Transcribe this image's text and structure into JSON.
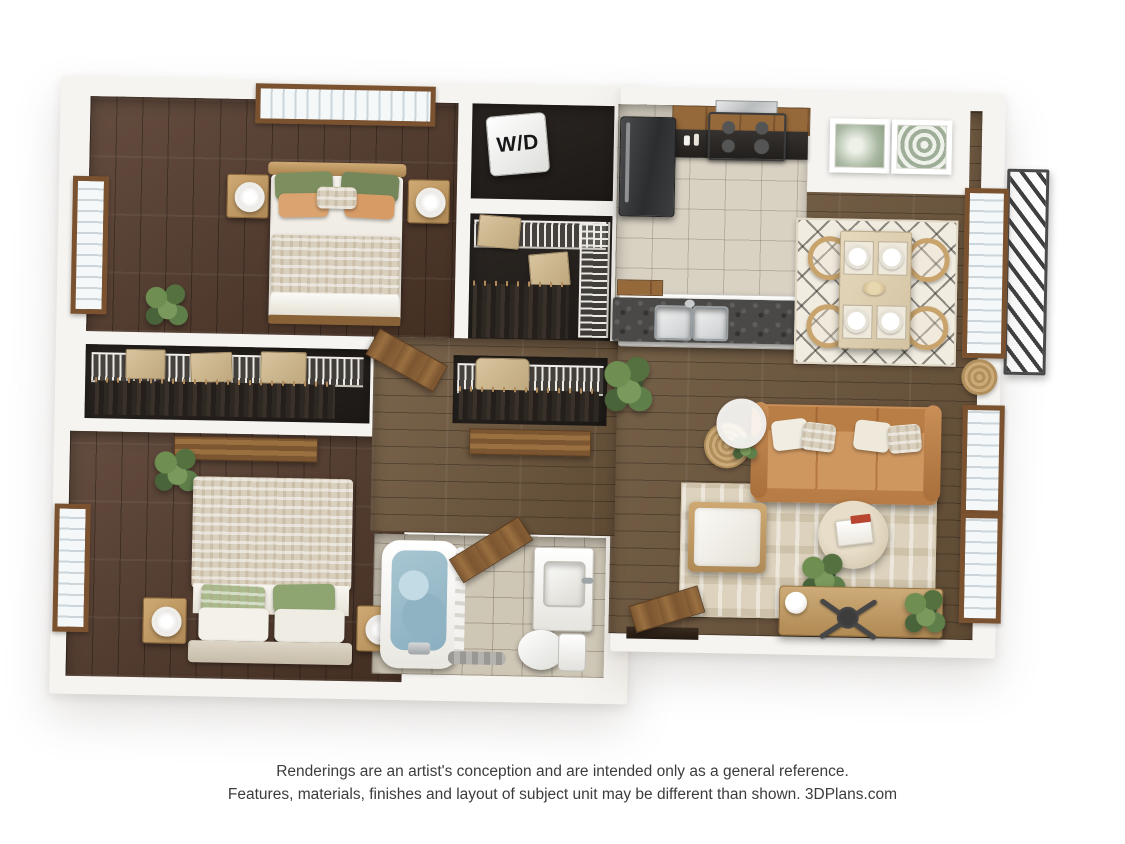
{
  "page": {
    "background_color": "#ffffff",
    "content_type": "3D floor plan rendering"
  },
  "labels": {
    "washer_dryer": "W/D"
  },
  "disclaimer": {
    "line1": "Renderings are an artist's conception and are intended only as a general reference.",
    "line2": "Features, materials, finishes and layout of subject unit may be different than shown. 3DPlans.com"
  },
  "palette": {
    "wall": "#f6f4f0",
    "dark_wood_floor": "#53392a",
    "wood_floor": "#6e563c",
    "kitchen_tile": "#d9d2c3",
    "bath_tile": "#cfc7b6",
    "closet_interior": "#221e1a",
    "window_frame": "#7a5230",
    "sofa_leather": "#c08552",
    "counter_granite": "#4a4947",
    "cabinet_wood": "#96693a",
    "accent_green": "#6f8f52",
    "pillow_green": "#7d8f5e",
    "pillow_tan": "#dba36f",
    "rug_cream": "#f1ece0",
    "water_blue": "#9dbfcc",
    "railing": "#3f3f3f"
  },
  "floor_plan": {
    "view": "top-down 3D dollhouse rendering of a 2-bed 1-bath apartment",
    "rooms": [
      {
        "name": "Bedroom 1",
        "position": "top-left",
        "floor": "dark wood",
        "furniture": [
          "queen bed with green and tan pillows",
          "two wood nightstands with white lamps",
          "picture window with blinds",
          "side window",
          "potted plant"
        ]
      },
      {
        "name": "Closet",
        "position": "left-center",
        "floor": "dark",
        "furniture": [
          "wire shelf",
          "three storage boxes",
          "hanging clothes"
        ]
      },
      {
        "name": "Bedroom 2",
        "position": "bottom-left",
        "floor": "dark wood",
        "furniture": [
          "queen bed with patterned duvet and green pillows",
          "two nightstands with lamps",
          "side window",
          "potted plant",
          "open wood door"
        ]
      },
      {
        "name": "Laundry closet",
        "position": "top-center",
        "label": "W/D",
        "furniture": [
          "stacked washer-dryer"
        ]
      },
      {
        "name": "Walk-in closet",
        "position": "center",
        "furniture": [
          "wire shelving on two walls",
          "baskets",
          "hanging clothes"
        ]
      },
      {
        "name": "Hall closet",
        "position": "center",
        "furniture": [
          "wire shelf",
          "basket",
          "hanging clothes",
          "sliding door"
        ]
      },
      {
        "name": "Bathroom",
        "position": "bottom-center",
        "floor": "tile",
        "furniture": [
          "soaking tub with water",
          "shower curtain",
          "vanity sink",
          "toilet",
          "bath mat",
          "swinging door"
        ]
      },
      {
        "name": "Kitchen",
        "position": "top-right",
        "floor": "tile",
        "furniture": [
          "refrigerator",
          "range with hood",
          "upper wood cabinets",
          "dark counters",
          "white peninsula with granite top and double sink",
          "potted plant"
        ]
      },
      {
        "name": "Dining area",
        "position": "right",
        "floor": "wood",
        "furniture": [
          "light wood table with four place settings",
          "four rattan chairs",
          "black-and-cream diamond rug",
          "two framed botanical prints"
        ]
      },
      {
        "name": "Living room",
        "position": "bottom-right",
        "floor": "wood",
        "furniture": [
          "camel leather sofa with cream pillows",
          "ring floor lamp",
          "round woven side table",
          "white armchair",
          "round coffee table with books",
          "patterned area rug",
          "wood desk with office chair",
          "plants",
          "open entry door"
        ]
      },
      {
        "name": "Balcony",
        "position": "right exterior",
        "furniture": [
          "dark metal railing"
        ]
      }
    ],
    "windows": {
      "left_wall": 2,
      "top_wall": 1,
      "right_wall": 3
    },
    "wall_decor": [
      "two botanical prints above dining area",
      "round woven hanging on right wall"
    ]
  }
}
